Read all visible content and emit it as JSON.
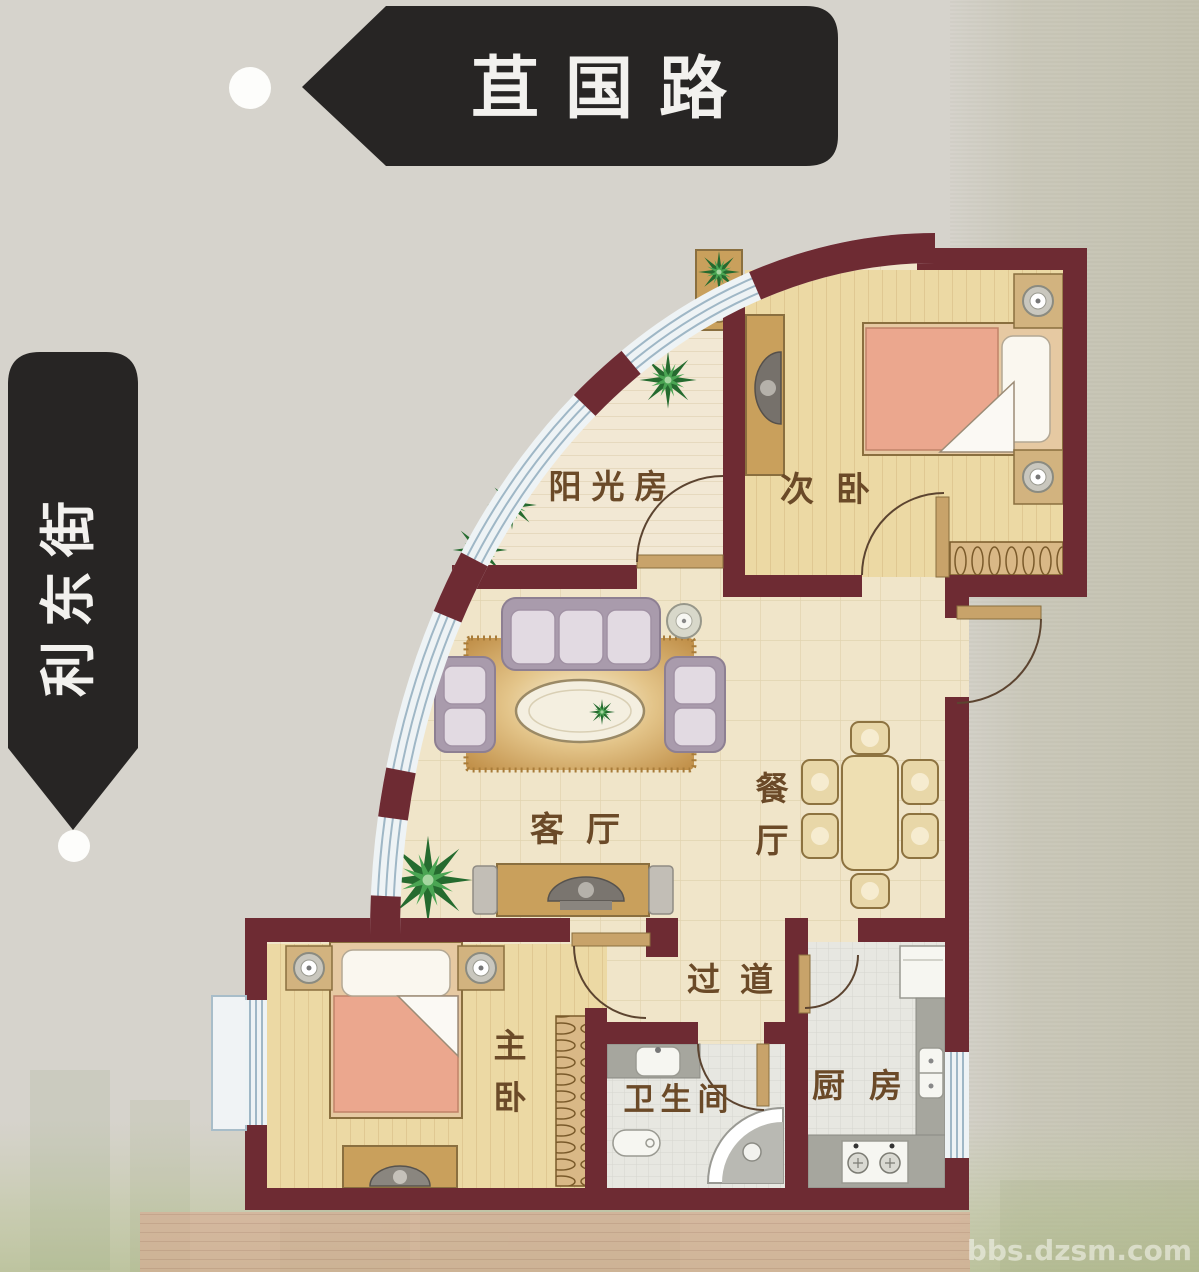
{
  "streets": {
    "top": {
      "label": "苴国路"
    },
    "left": {
      "label": "利东街"
    }
  },
  "rooms": {
    "sunroom": {
      "label": "阳光房"
    },
    "second_bedroom": {
      "label": "次卧"
    },
    "living_room": {
      "label": "客厅"
    },
    "dining_room": {
      "label": "餐厅"
    },
    "corridor": {
      "label": "过道"
    },
    "master_bedroom": {
      "label": "主卧"
    },
    "bathroom": {
      "label": "卫生间"
    },
    "kitchen": {
      "label": "厨房"
    }
  },
  "watermark": {
    "label": "bbs.dzsm.com"
  },
  "colors": {
    "wall": "#6e2b33",
    "banner": "#272524",
    "floor_main": "#f0e5c9",
    "floor_wood": "#ecd9a4",
    "floor_sunroom": "#f2e8d4",
    "floor_wet": "#e7e7e1",
    "glass": "#eef3f5",
    "glass_stripe": "#9fb7c6",
    "label_text": "#6b4a28",
    "door": "#c8a36a"
  }
}
